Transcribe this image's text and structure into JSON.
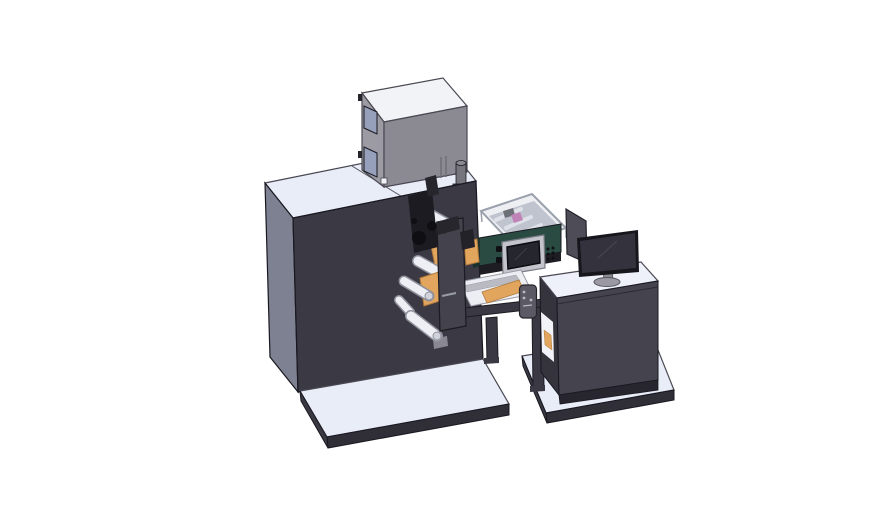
{
  "scene": {
    "type": "cad-3d-render",
    "background": "#ffffff"
  },
  "parts": {
    "cabinet": {
      "front": "#3a3944",
      "side": "#7e8191",
      "top": "#e9edf8",
      "edge": "#4a4953",
      "dark_edge": "#191820",
      "notch": "#8a8992",
      "seam": "#55545e"
    },
    "top_box": {
      "front": "#8b8a93",
      "side": "#9c9ba4",
      "top": "#f2f3f7",
      "window": "#96a0ba",
      "tab": "#26252c",
      "cylinder": "#76757d",
      "cylinder_top": "#8a8992",
      "flange": "#55545e",
      "white_square": "#f0f1f5",
      "vent": "#6e6d75"
    },
    "print_engine": {
      "body": "#294b42",
      "body_side": "#17332c",
      "underside": "#1d1d23",
      "cover_glass": "#ccd0db",
      "cover_rim": "#9aa0ac",
      "cover_interior": "#b9bdc8",
      "web_strip": "#e8eaf1",
      "pink_part": "#b85aa5",
      "inner_dark": "#3c3c44"
    },
    "hmi": {
      "frame": "#c3c4cc",
      "frame_edge": "#7a7b84",
      "screen": "#26262e",
      "screen_edge": "#0c0c10",
      "button": "#0f0f13",
      "glare": "#3e3e48"
    },
    "mechanism": {
      "head": "#1b1b21",
      "head_top": "#26262c",
      "bracket": "#26262c",
      "bracket2": "#222228",
      "tower": "#44434d",
      "tower_edge": "#1c1b22",
      "hub": "#0f0f13",
      "roller_fill": "#edeff5",
      "roller_stroke": "#8e909b",
      "roller_cap": "#cfd2db",
      "web": "#e1a55e",
      "web_edge": "#b27a3a",
      "label_line": "#9a9ca4"
    },
    "stand": {
      "frame": "#3a3943",
      "frame_edge": "#1c1b22",
      "ramp": "#eceef4",
      "ramp_edge": "#9a9ca6",
      "pendant": "#5a5964",
      "pendant_edge": "#26252c",
      "pendant_dot": "#b9bac2"
    },
    "shield": {
      "panel": "#4e4d57",
      "edge": "#23222a"
    },
    "desk": {
      "top": "#eef1f9",
      "front": "#45444e",
      "side": "#35343d",
      "bottom": "#27262e",
      "seam": "#2b2a33",
      "shelf": "#f2f3f8",
      "web_sliver": "#e1a55e"
    },
    "monitor": {
      "bezel": "#17161c",
      "screen": "#34333d",
      "glare": "#45444f",
      "stand": "#8a8992",
      "base": "#9a99a2",
      "base_edge": "#55545e"
    },
    "base_plates": {
      "top": "#e9edf8",
      "edge": "#302f38",
      "side": "#3a3943",
      "outline": "#4a4953"
    }
  }
}
